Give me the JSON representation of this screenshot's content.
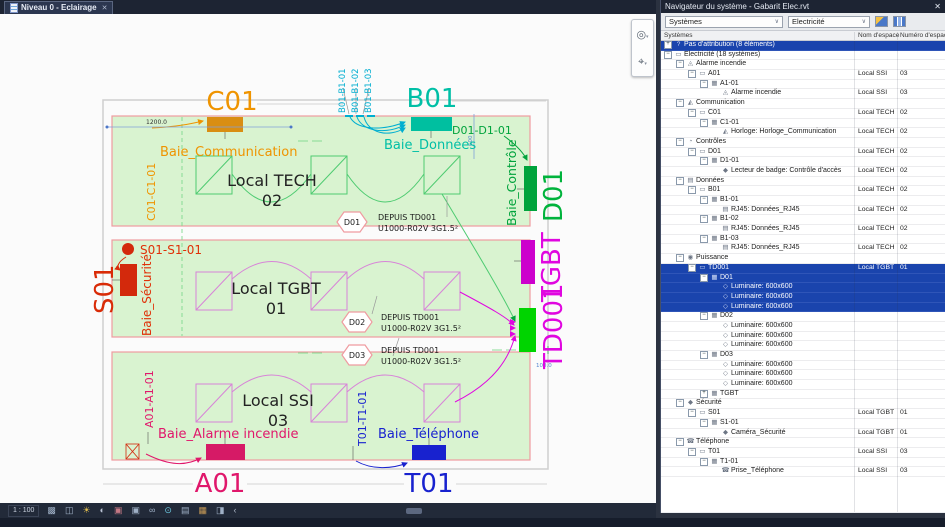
{
  "tab": {
    "title": "Niveau 0 - Eclairage",
    "close": "✕"
  },
  "canvas": {
    "scale": "1 : 100",
    "view_icons": [
      "visual-style",
      "box-3d",
      "sun-lighting",
      "shadows",
      "crop-off",
      "crop-visible",
      "glasses-hide",
      "reveal-hidden",
      "hide-analytical",
      "displaced-elements",
      "reveal-constraints",
      "chevron-left"
    ],
    "nav_icons": [
      "steering-wheel",
      "zoom"
    ]
  },
  "drawing": {
    "labels": {
      "c01": "C01",
      "b01": "B01",
      "b1_tags": [
        "B01-B1-01",
        "B01-B1-02",
        "B01-B1-03"
      ],
      "baie_communication": "Baie_Communication",
      "c01_tag": "C01-C1-01",
      "baie_donnees": "Baie_Données",
      "d01_tag": "D01-D1-01",
      "baie_controle": "Baie_Contrôle",
      "d01": "D01",
      "tgbt": "TGBT",
      "td001": "TD001",
      "s01_tag": "S01-S1-01",
      "s01": "S01",
      "baie_securite": "Baie_Sécurité",
      "a01_tag": "A01-A1-01",
      "baie_alarme": "Baie_Alarme incendie",
      "a01": "A01",
      "t01_tag": "T01-T1-01",
      "baie_telephone": "Baie_Téléphone",
      "t01": "T01"
    },
    "rooms": [
      {
        "name": "Local TECH",
        "num": "02"
      },
      {
        "name": "Local TGBT",
        "num": "01"
      },
      {
        "name": "Local SSI",
        "num": "03"
      }
    ],
    "circuit_tags": [
      {
        "id": "D01",
        "line1": "DEPUIS TD001",
        "line2": "U1000-R02V 3G1.5²"
      },
      {
        "id": "D02",
        "line1": "DEPUIS TD001",
        "line2": "U1000-R02V 3G1.5²"
      },
      {
        "id": "D03",
        "line1": "DEPUIS TD001",
        "line2": "U1000-R02V 3G1.5²"
      }
    ],
    "dims": {
      "d1200": "1200.0",
      "d600": "600",
      "d100": "100.0"
    },
    "colors": {
      "room_fill": "#d9f3d0",
      "room_border": "#ef9ba0",
      "orange": "#ef9400",
      "teal": "#00bfa6",
      "cyan": "#00aed0",
      "green": "#00a33c",
      "bright_green": "#00d400",
      "magenta": "#e006e0",
      "red": "#d92b07",
      "pink": "#e0176b",
      "blue": "#1822cf"
    }
  },
  "panel": {
    "title": "Navigateur du système - Gabarit Elec.rvt",
    "close": "✕",
    "combo_view": "Systèmes",
    "combo_discipline": "Electricité",
    "columns": [
      "Systèmes",
      "Nom d'espace",
      "Numéro d'espace"
    ],
    "rows": [
      {
        "lvl": 0,
        "exp": "+",
        "icon": "question",
        "label": "Pas d'attribution (8 éléments)",
        "space": "",
        "num": "",
        "sel": true
      },
      {
        "lvl": 0,
        "exp": "-",
        "icon": "folder",
        "label": "Electricité (18 systèmes)",
        "space": "",
        "num": ""
      },
      {
        "lvl": 1,
        "exp": "-",
        "icon": "fire",
        "label": "Alarme incendie",
        "space": "",
        "num": ""
      },
      {
        "lvl": 2,
        "exp": "-",
        "icon": "folder",
        "label": "A01",
        "space": "Local SSI",
        "num": "03"
      },
      {
        "lvl": 3,
        "exp": "-",
        "icon": "panel",
        "label": "A1-01",
        "space": "",
        "num": ""
      },
      {
        "lvl": 4,
        "icon": "fire",
        "label": "Alarme incendie",
        "space": "Local SSI",
        "num": "03"
      },
      {
        "lvl": 1,
        "exp": "-",
        "icon": "antenna",
        "label": "Communication",
        "space": "",
        "num": ""
      },
      {
        "lvl": 2,
        "exp": "-",
        "icon": "folder",
        "label": "C01",
        "space": "Local TECH",
        "num": "02"
      },
      {
        "lvl": 3,
        "exp": "-",
        "icon": "panel",
        "label": "C1-01",
        "space": "",
        "num": ""
      },
      {
        "lvl": 4,
        "icon": "antenna",
        "label": "Horloge: Horloge_Communication",
        "space": "Local TECH",
        "num": "02"
      },
      {
        "lvl": 1,
        "exp": "-",
        "icon": "controls",
        "label": "Contrôles",
        "space": "",
        "num": ""
      },
      {
        "lvl": 2,
        "exp": "-",
        "icon": "folder",
        "label": "D01",
        "space": "Local TECH",
        "num": "02"
      },
      {
        "lvl": 3,
        "exp": "-",
        "icon": "panel",
        "label": "D1-01",
        "space": "",
        "num": ""
      },
      {
        "lvl": 4,
        "icon": "shield",
        "label": "Lecteur de badge: Contrôle d'accès",
        "space": "Local TECH",
        "num": "02"
      },
      {
        "lvl": 1,
        "exp": "-",
        "icon": "data",
        "label": "Données",
        "space": "",
        "num": ""
      },
      {
        "lvl": 2,
        "exp": "-",
        "icon": "folder",
        "label": "B01",
        "space": "Local TECH",
        "num": "02"
      },
      {
        "lvl": 3,
        "exp": "-",
        "icon": "panel",
        "label": "B1-01",
        "space": "",
        "num": ""
      },
      {
        "lvl": 4,
        "icon": "rj45",
        "label": "RJ45: Données_RJ45",
        "space": "Local TECH",
        "num": "02"
      },
      {
        "lvl": 3,
        "exp": "-",
        "icon": "panel",
        "label": "B1-02",
        "space": "",
        "num": ""
      },
      {
        "lvl": 4,
        "icon": "rj45",
        "label": "RJ45: Données_RJ45",
        "space": "Local TECH",
        "num": "02"
      },
      {
        "lvl": 3,
        "exp": "-",
        "icon": "panel",
        "label": "B1-03",
        "space": "",
        "num": ""
      },
      {
        "lvl": 4,
        "icon": "rj45",
        "label": "RJ45: Données_RJ45",
        "space": "Local TECH",
        "num": "02"
      },
      {
        "lvl": 1,
        "exp": "-",
        "icon": "power",
        "label": "Puissance",
        "space": "",
        "num": ""
      },
      {
        "lvl": 2,
        "exp": "-",
        "icon": "folder",
        "label": "TD001",
        "space": "Local TGBT",
        "num": "01",
        "sel": true
      },
      {
        "lvl": 3,
        "exp": "-",
        "icon": "panel",
        "label": "D01",
        "space": "",
        "num": "",
        "sel": true
      },
      {
        "lvl": 4,
        "icon": "lum",
        "label": "Luminaire: 600x600",
        "space": "",
        "num": "",
        "sel": true
      },
      {
        "lvl": 4,
        "icon": "lum",
        "label": "Luminaire: 600x600",
        "space": "",
        "num": "",
        "sel": true
      },
      {
        "lvl": 4,
        "icon": "lum",
        "label": "Luminaire: 600x600",
        "space": "",
        "num": "",
        "sel": true
      },
      {
        "lvl": 3,
        "exp": "-",
        "icon": "panel",
        "label": "D02",
        "space": "",
        "num": ""
      },
      {
        "lvl": 4,
        "icon": "lum",
        "label": "Luminaire: 600x600",
        "space": "",
        "num": ""
      },
      {
        "lvl": 4,
        "icon": "lum",
        "label": "Luminaire: 600x600",
        "space": "",
        "num": ""
      },
      {
        "lvl": 4,
        "icon": "lum",
        "label": "Luminaire: 600x600",
        "space": "",
        "num": ""
      },
      {
        "lvl": 3,
        "exp": "-",
        "icon": "panel",
        "label": "D03",
        "space": "",
        "num": ""
      },
      {
        "lvl": 4,
        "icon": "lum",
        "label": "Luminaire: 600x600",
        "space": "",
        "num": ""
      },
      {
        "lvl": 4,
        "icon": "lum",
        "label": "Luminaire: 600x600",
        "space": "",
        "num": ""
      },
      {
        "lvl": 4,
        "icon": "lum",
        "label": "Luminaire: 600x600",
        "space": "",
        "num": ""
      },
      {
        "lvl": 3,
        "exp": "+",
        "icon": "panel",
        "label": "TGBT",
        "space": "",
        "num": ""
      },
      {
        "lvl": 1,
        "exp": "-",
        "icon": "shield",
        "label": "Sécurité",
        "space": "",
        "num": ""
      },
      {
        "lvl": 2,
        "exp": "-",
        "icon": "folder",
        "label": "S01",
        "space": "Local TGBT",
        "num": "01"
      },
      {
        "lvl": 3,
        "exp": "-",
        "icon": "panel",
        "label": "S1-01",
        "space": "",
        "num": ""
      },
      {
        "lvl": 4,
        "icon": "shield",
        "label": "Caméra_Sécurité",
        "space": "Local TGBT",
        "num": "01"
      },
      {
        "lvl": 1,
        "exp": "-",
        "icon": "phone",
        "label": "Téléphone",
        "space": "",
        "num": ""
      },
      {
        "lvl": 2,
        "exp": "-",
        "icon": "folder",
        "label": "T01",
        "space": "Local SSI",
        "num": "03"
      },
      {
        "lvl": 3,
        "exp": "-",
        "icon": "panel",
        "label": "T1-01",
        "space": "",
        "num": ""
      },
      {
        "lvl": 4,
        "icon": "phone",
        "label": "Prise_Téléphone",
        "space": "Local SSI",
        "num": "03"
      }
    ]
  }
}
